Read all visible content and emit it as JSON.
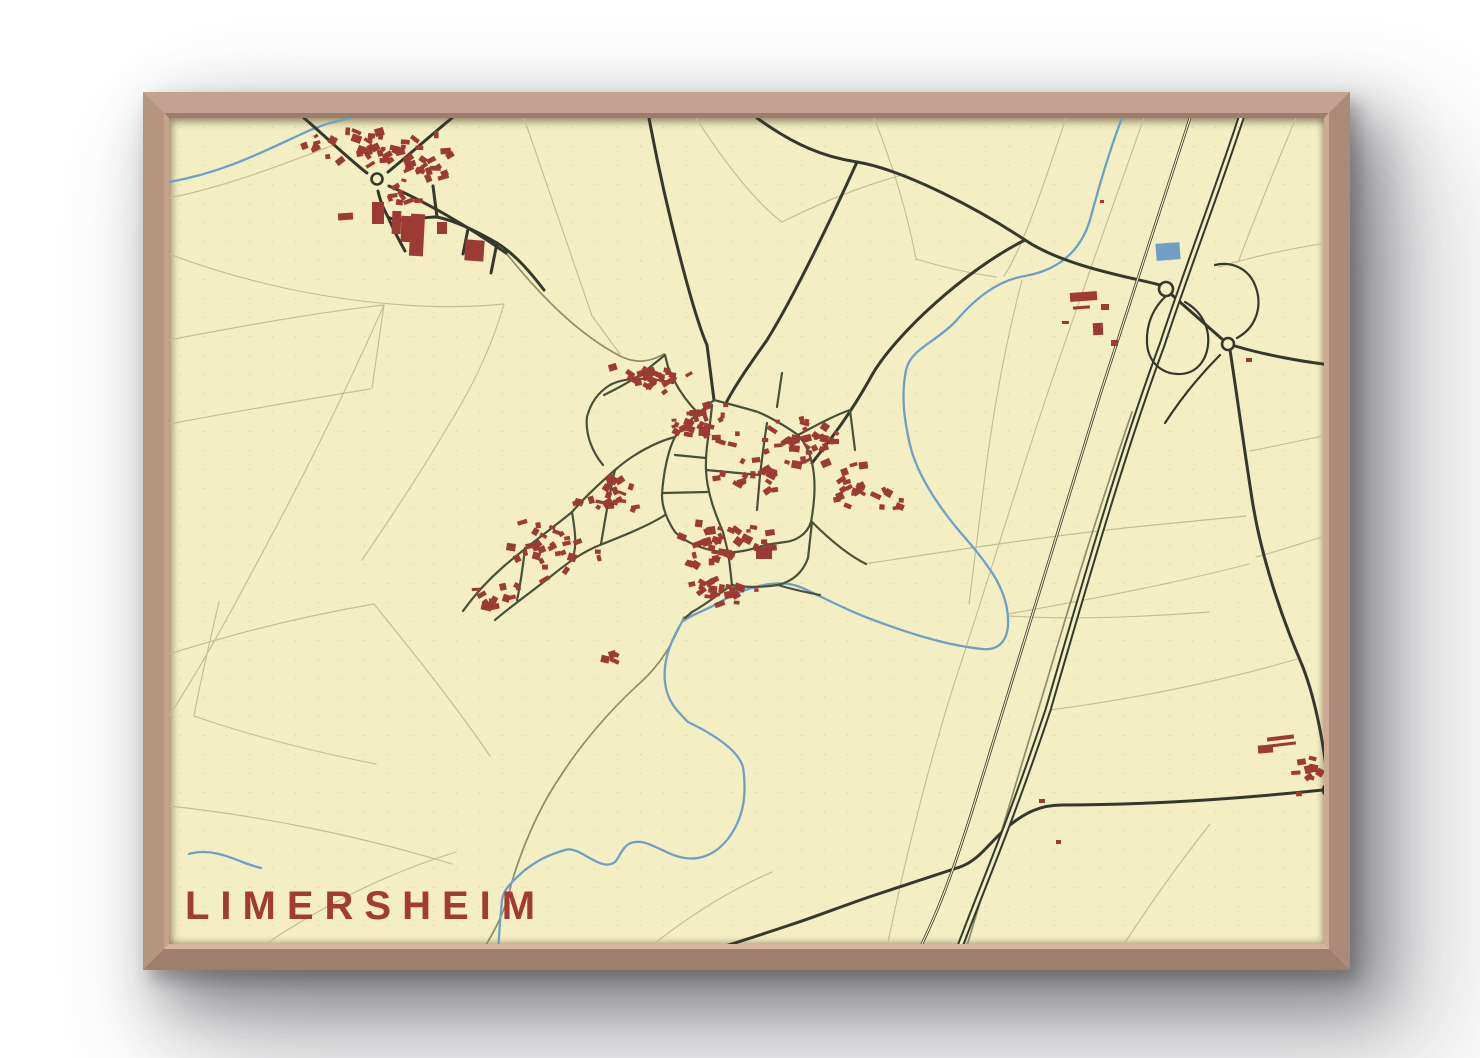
{
  "poster": {
    "title": "LIMERSHEIM",
    "colors": {
      "paper": "#f3efc3",
      "building": "#9c3a33",
      "water": "#6fa0c4",
      "road": "#35392b",
      "street": "#4a5139",
      "track": "#8f8c68",
      "parcel": "#c3bd92",
      "title": "#a23b32",
      "frame": "#b2907e"
    }
  },
  "map": {
    "viewbox": "165 114 1163 834",
    "width": 1163,
    "height": 834,
    "parcels": [
      "M 165,250 C 250,282 330,296 400,301 C 440,304 470,303 500,300",
      "M 500,300 C 488,342 468,384 444,422 C 418,467 388,512 358,556",
      "M 380,301 C 345,380 305,462 262,542 C 230,602 198,662 165,712",
      "M 165,336 C 238,322 310,309 380,301",
      "M 165,420 C 230,408 298,396 366,385",
      "M 368,384 C 372,356 376,328 380,301",
      "M 215,598 C 206,636 197,674 190,712",
      "M 190,712 C 250,733 312,748 372,760",
      "M 165,650 C 232,629 300,612 370,600",
      "M 370,600 C 412,652 452,702 486,752",
      "M 250,948 C 310,906 380,870 452,848",
      "M 165,802 C 258,812 356,832 448,860",
      "M 520,114 C 545,186 568,252 588,312 L 616,350",
      "M 692,114 C 724,164 754,200 778,218",
      "M 778,218 C 820,197 860,181 902,170",
      "M 870,114 C 890,164 904,213 912,255 C 938,263 964,269 992,273",
      "M 1062,114 C 1040,180 1018,246 1000,272",
      "M 1140,114 C 1106,210 1070,310 1040,400 C 1010,490 980,590 950,680 C 925,760 902,850 882,948",
      "M 1292,114 C 1270,166 1250,216 1235,256",
      "M 1328,238 C 1290,244 1250,252 1215,263",
      "M 1245,560 C 1160,582 1076,597 1004,610",
      "M 1005,612 C 1070,616 1140,613 1205,608",
      "M 1293,655 C 1212,679 1122,696 1046,706",
      "M 1328,530 C 1295,540 1268,549 1252,553",
      "M 1328,430 C 1300,436 1272,442 1246,447",
      "M 1115,948 C 1145,901 1176,858 1206,820",
      "M 165,194 C 224,182 280,160 330,141",
      "M 1018,276 C 1000,345 988,414 980,480 C 972,545 968,578 965,600",
      "M 860,560 C 958,545 1058,530 1150,521 L 1242,512",
      "M 640,948 C 680,915 722,888 768,868"
    ],
    "tracks": [
      "M 502,249 C 540,296 576,331 616,352 C 632,360 646,358 660,350",
      "M 680,613 C 668,641 656,661 636,679 C 606,706 576,741 554,776 C 534,806 517,846 507,881 C 500,913 487,932 478,948",
      "M 1128,408 C 1100,490 1070,585 1042,680 C 1016,765 990,850 965,935 L 961,948"
    ],
    "water": [
      "M 165,178 C 222,168 262,146 302,128 C 322,119 334,117 347,114",
      "M 1118,114 C 1104,150 1094,186 1086,216 C 1075,252 1049,267 1021,272 C 991,277 969,297 951,318 C 929,340 907,345 902,366 C 897,392 900,415 906,441 C 914,474 939,509 963,536 C 986,563 1003,586 1004,615 C 1005,635 996,647 978,645 C 940,641 901,628 864,614 C 831,601 813,590 796,583 C 771,573 736,586 716,598 C 701,607 686,611 678,618 C 664,641 659,661 661,678 C 663,698 674,708 684,718 C 711,731 734,746 739,763 C 743,791 739,809 731,824 C 719,846 701,857 681,854 C 661,851 646,836 631,838 C 619,839 616,853 611,858 C 596,869 576,841 561,846 C 541,852 533,857 521,866 C 506,879 499,887 498,896 C 496,916 495,931 494,948",
      "M 185,850 C 205,844 226,853 241,859 C 249,862 253,863 257,864"
    ],
    "pond": {
      "x": 1152,
      "y": 239,
      "w": 24,
      "h": 17,
      "rot": -4
    },
    "roads": [
      "M 300,114 C 322,133 346,156 363,169",
      "M 384,168 C 406,150 426,132 448,114",
      "M 385,182 C 420,197 462,221 502,249",
      "M 374,187 C 376,196 380,206 384,213 C 396,220 412,213 433,213 C 452,217 472,227 493,239 C 512,251 527,269 540,286",
      "M 433,213 L 429,182",
      "M 464,225 L 459,250",
      "M 493,239 L 487,269",
      "M 384,213 C 390,227 396,238 401,247",
      "M 645,114 C 662,206 690,312 703,341 L 710,396",
      "M 753,114 C 790,141 820,153 853,158 C 901,166 976,206 1021,236 C 1061,263 1131,274 1156,281",
      "M 853,158 C 829,211 791,291 763,336 C 749,356 731,381 721,401",
      "M 808,459 C 826,436 846,411 868,371 C 891,331 961,266 1021,236",
      "M 1168,291 L 1218,335",
      "M 1231,342 C 1261,351 1300,358 1328,361",
      "M 1226,346 C 1233,391 1241,451 1249,501 C 1259,561 1281,621 1296,656 C 1311,691 1320,741 1324,780",
      "M 1326,792 C 1329,831 1331,891 1332,948",
      "M 1319,786 C 1251,793 1151,801 1058,801 C 1036,801 1021,809 1006,821 C 986,837 976,856 956,863 C 931,871 901,881 871,891 C 841,901 811,913 786,921 C 756,931 726,941 701,948"
    ],
    "ramps": [
      "M 1162,292 C 1150,303 1142,319 1143,339 C 1144,357 1156,369 1173,370 C 1191,371 1202,358 1204,341 C 1206,323 1197,307 1181,298",
      "M 1233,334 C 1253,323 1259,301 1251,281 C 1244,264 1227,257 1211,261",
      "M 1216,351 C 1196,371 1176,396 1161,419"
    ],
    "streets": [
      "M 710,396 C 695,409 679,421 671,433 C 664,446 659,471 658,491 C 658,503 663,516 671,528 C 681,538 696,544 711,547 C 726,550 741,548 761,541",
      "M 710,396 C 725,400 741,404 754,408 C 766,413 783,423 794,431 C 803,441 806,451 808,459 C 812,476 811,496 807,518 C 803,531 791,537 781,538 L 761,541",
      "M 708,401 C 706,426 701,446 702,466 C 703,489 711,509 719,528",
      "M 671,451 L 702,454",
      "M 659,489 L 703,488",
      "M 702,466 L 756,471",
      "M 763,419 C 760,438 758,455 756,471 L 753,506",
      "M 694,409 C 681,396 671,381 664,363 L 661,351",
      "M 669,379 C 646,373 621,373 606,381 C 593,389 586,401 583,413 C 581,431 589,449 599,461",
      "M 671,433 C 651,438 628,451 611,466 C 596,479 581,493 568,508 C 546,526 521,544 499,563 C 483,577 469,593 459,607",
      "M 661,511 C 646,521 621,531 596,541 C 576,549 561,561 546,573 C 526,589 506,603 491,616",
      "M 568,508 C 571,526 573,541 569,553",
      "M 521,544 C 519,561 517,579 513,596",
      "M 611,466 C 605,491 601,516 597,540",
      "M 719,528 L 724,548 C 726,561 727,573 728,581",
      "M 728,581 C 716,589 701,601 688,608 L 681,614",
      "M 728,581 C 741,584 761,583 774,581 C 786,578 798,571 804,554 L 808,518",
      "M 774,581 C 790,586 806,589 816,591",
      "M 773,403 L 778,369",
      "M 794,431 C 813,421 831,411 846,406",
      "M 846,406 L 851,446",
      "M 661,351 L 640,368 C 626,378 612,385 600,391",
      "M 808,518 C 830,540 848,553 862,560"
    ],
    "motorway": "M 1237,114 C 1212,190 1182,268 1158,341 C 1121,441 1086,561 1044,706 C 1002,831 976,888 954,948",
    "railway": "M 1186,114 C 1161,190 1131,281 1096,391 C 1061,501 1021,631 976,781 C 946,881 928,920 914,948",
    "roundabouts": [
      [
        373,
        175,
        5.5
      ],
      [
        1162,
        285,
        7
      ],
      [
        1224,
        340,
        6
      ],
      [
        1325,
        786,
        6
      ]
    ],
    "buildings": [
      [
        368,
        198,
        12,
        22,
        0
      ],
      [
        388,
        207,
        9,
        23,
        2
      ],
      [
        397,
        212,
        12,
        26,
        2
      ],
      [
        406,
        210,
        14,
        42,
        3
      ],
      [
        433,
        218,
        10,
        12,
        0
      ],
      [
        461,
        236,
        19,
        21,
        4
      ],
      [
        334,
        209,
        15,
        7,
        -4
      ],
      [
        752,
        543,
        16,
        12,
        0
      ],
      [
        1066,
        288,
        27,
        9,
        -4
      ],
      [
        1097,
        300,
        8,
        6,
        0
      ],
      [
        1069,
        302,
        17,
        3,
        -4
      ],
      [
        1089,
        319,
        10,
        12,
        -3
      ],
      [
        1107,
        336,
        7,
        6,
        0
      ],
      [
        1058,
        317,
        7,
        3,
        0
      ],
      [
        1254,
        741,
        15,
        8,
        -5
      ],
      [
        1263,
        732,
        27,
        4,
        -7
      ],
      [
        1265,
        739,
        27,
        3,
        -7
      ],
      [
        1242,
        354,
        6,
        4,
        0
      ],
      [
        1035,
        795,
        6,
        4,
        0
      ],
      [
        1052,
        836,
        5,
        4,
        0
      ],
      [
        1096,
        196,
        4,
        3,
        0
      ]
    ],
    "clusters": [
      [
        380,
        146,
        78,
        26,
        40,
        11
      ],
      [
        424,
        168,
        38,
        16,
        14,
        12
      ],
      [
        313,
        140,
        14,
        9,
        5,
        13
      ],
      [
        400,
        190,
        28,
        12,
        9,
        14
      ],
      [
        652,
        374,
        46,
        16,
        24,
        21
      ],
      [
        700,
        424,
        52,
        26,
        30,
        22
      ],
      [
        798,
        438,
        44,
        32,
        36,
        23
      ],
      [
        843,
        478,
        22,
        28,
        16,
        24
      ],
      [
        884,
        497,
        18,
        22,
        7,
        25
      ],
      [
        718,
        540,
        58,
        28,
        34,
        26
      ],
      [
        548,
        545,
        52,
        33,
        30,
        27
      ],
      [
        602,
        489,
        38,
        28,
        22,
        28
      ],
      [
        716,
        588,
        44,
        18,
        20,
        29
      ],
      [
        492,
        590,
        28,
        22,
        12,
        30
      ],
      [
        742,
        470,
        36,
        22,
        18,
        31
      ],
      [
        1301,
        770,
        20,
        26,
        10,
        32
      ],
      [
        602,
        654,
        22,
        10,
        4,
        33
      ]
    ]
  }
}
